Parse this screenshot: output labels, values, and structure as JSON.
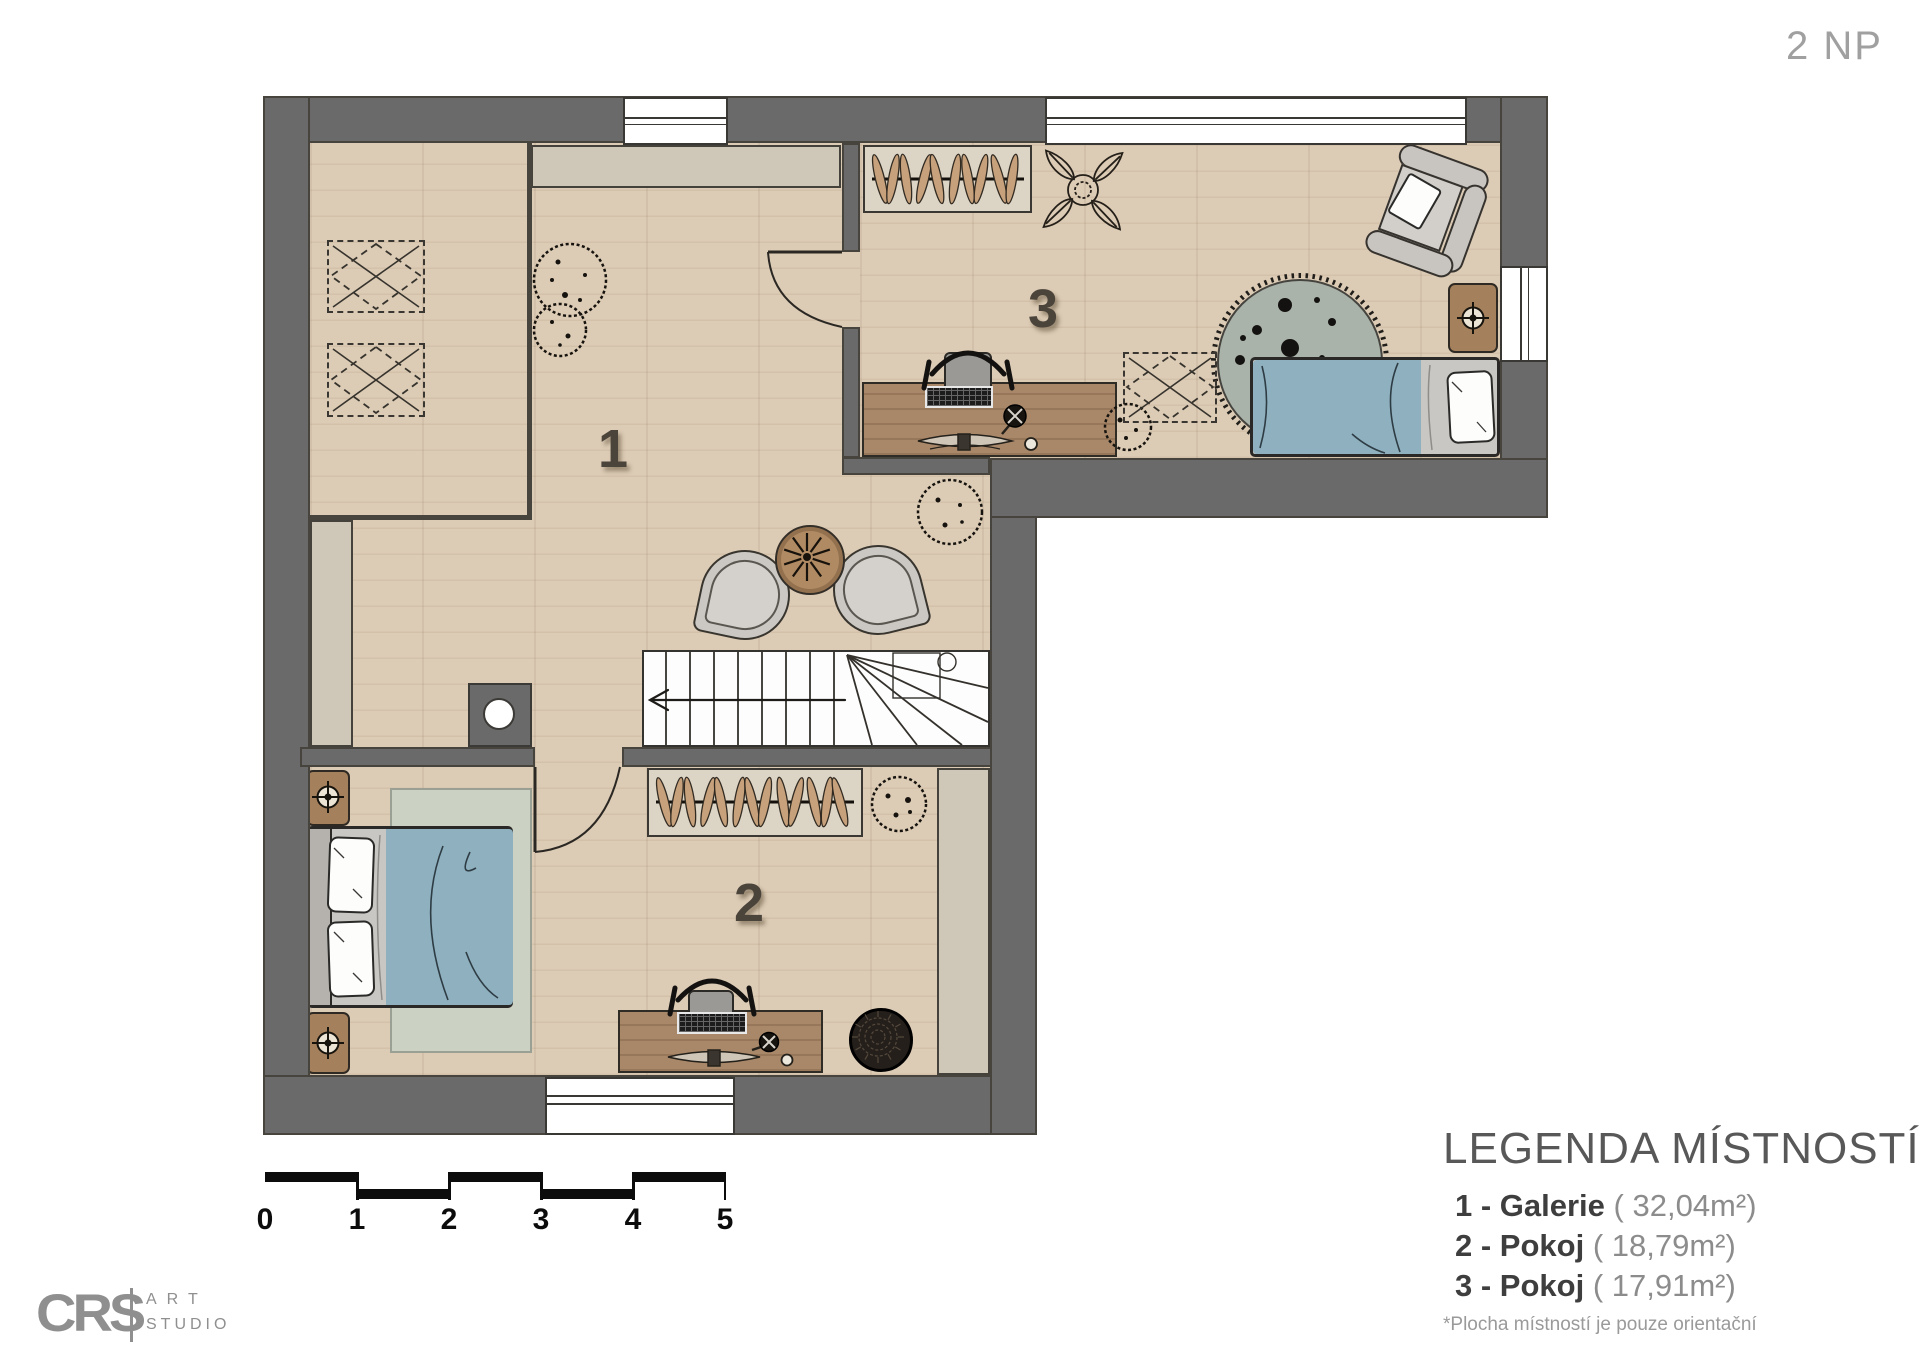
{
  "title": {
    "floor_label": "2 NP"
  },
  "rooms": [
    {
      "number": "1",
      "name": "Galerie",
      "area_m2": "32,04"
    },
    {
      "number": "2",
      "name": "Pokoj",
      "area_m2": "18,79"
    },
    {
      "number": "3",
      "name": "Pokoj",
      "area_m2": "17,91"
    }
  ],
  "legend": {
    "title": "LEGENDA MÍSTNOSTÍ",
    "items": [
      {
        "label": "1 - Galerie",
        "area": "( 32,04m²)"
      },
      {
        "label": "2 - Pokoj",
        "area": "( 18,79m²)"
      },
      {
        "label": "3 - Pokoj",
        "area": "( 17,91m²)"
      }
    ],
    "footnote": "*Plocha místností je pouze orientační"
  },
  "scale_bar": {
    "labels": [
      "0",
      "1",
      "2",
      "3",
      "4",
      "5"
    ]
  },
  "logo": {
    "brand": "CRS",
    "line1": "ART",
    "line2": "STUDIO"
  },
  "colors": {
    "wall": "#6a6a6a",
    "floor": "#dccbb5",
    "duvet_blue": "#8fb0bf",
    "rug_green": "#a9b3aa",
    "rug_light": "#ccd2c3",
    "desk_wood": "#a9886a",
    "knee_wall": "#cfc8b9"
  }
}
